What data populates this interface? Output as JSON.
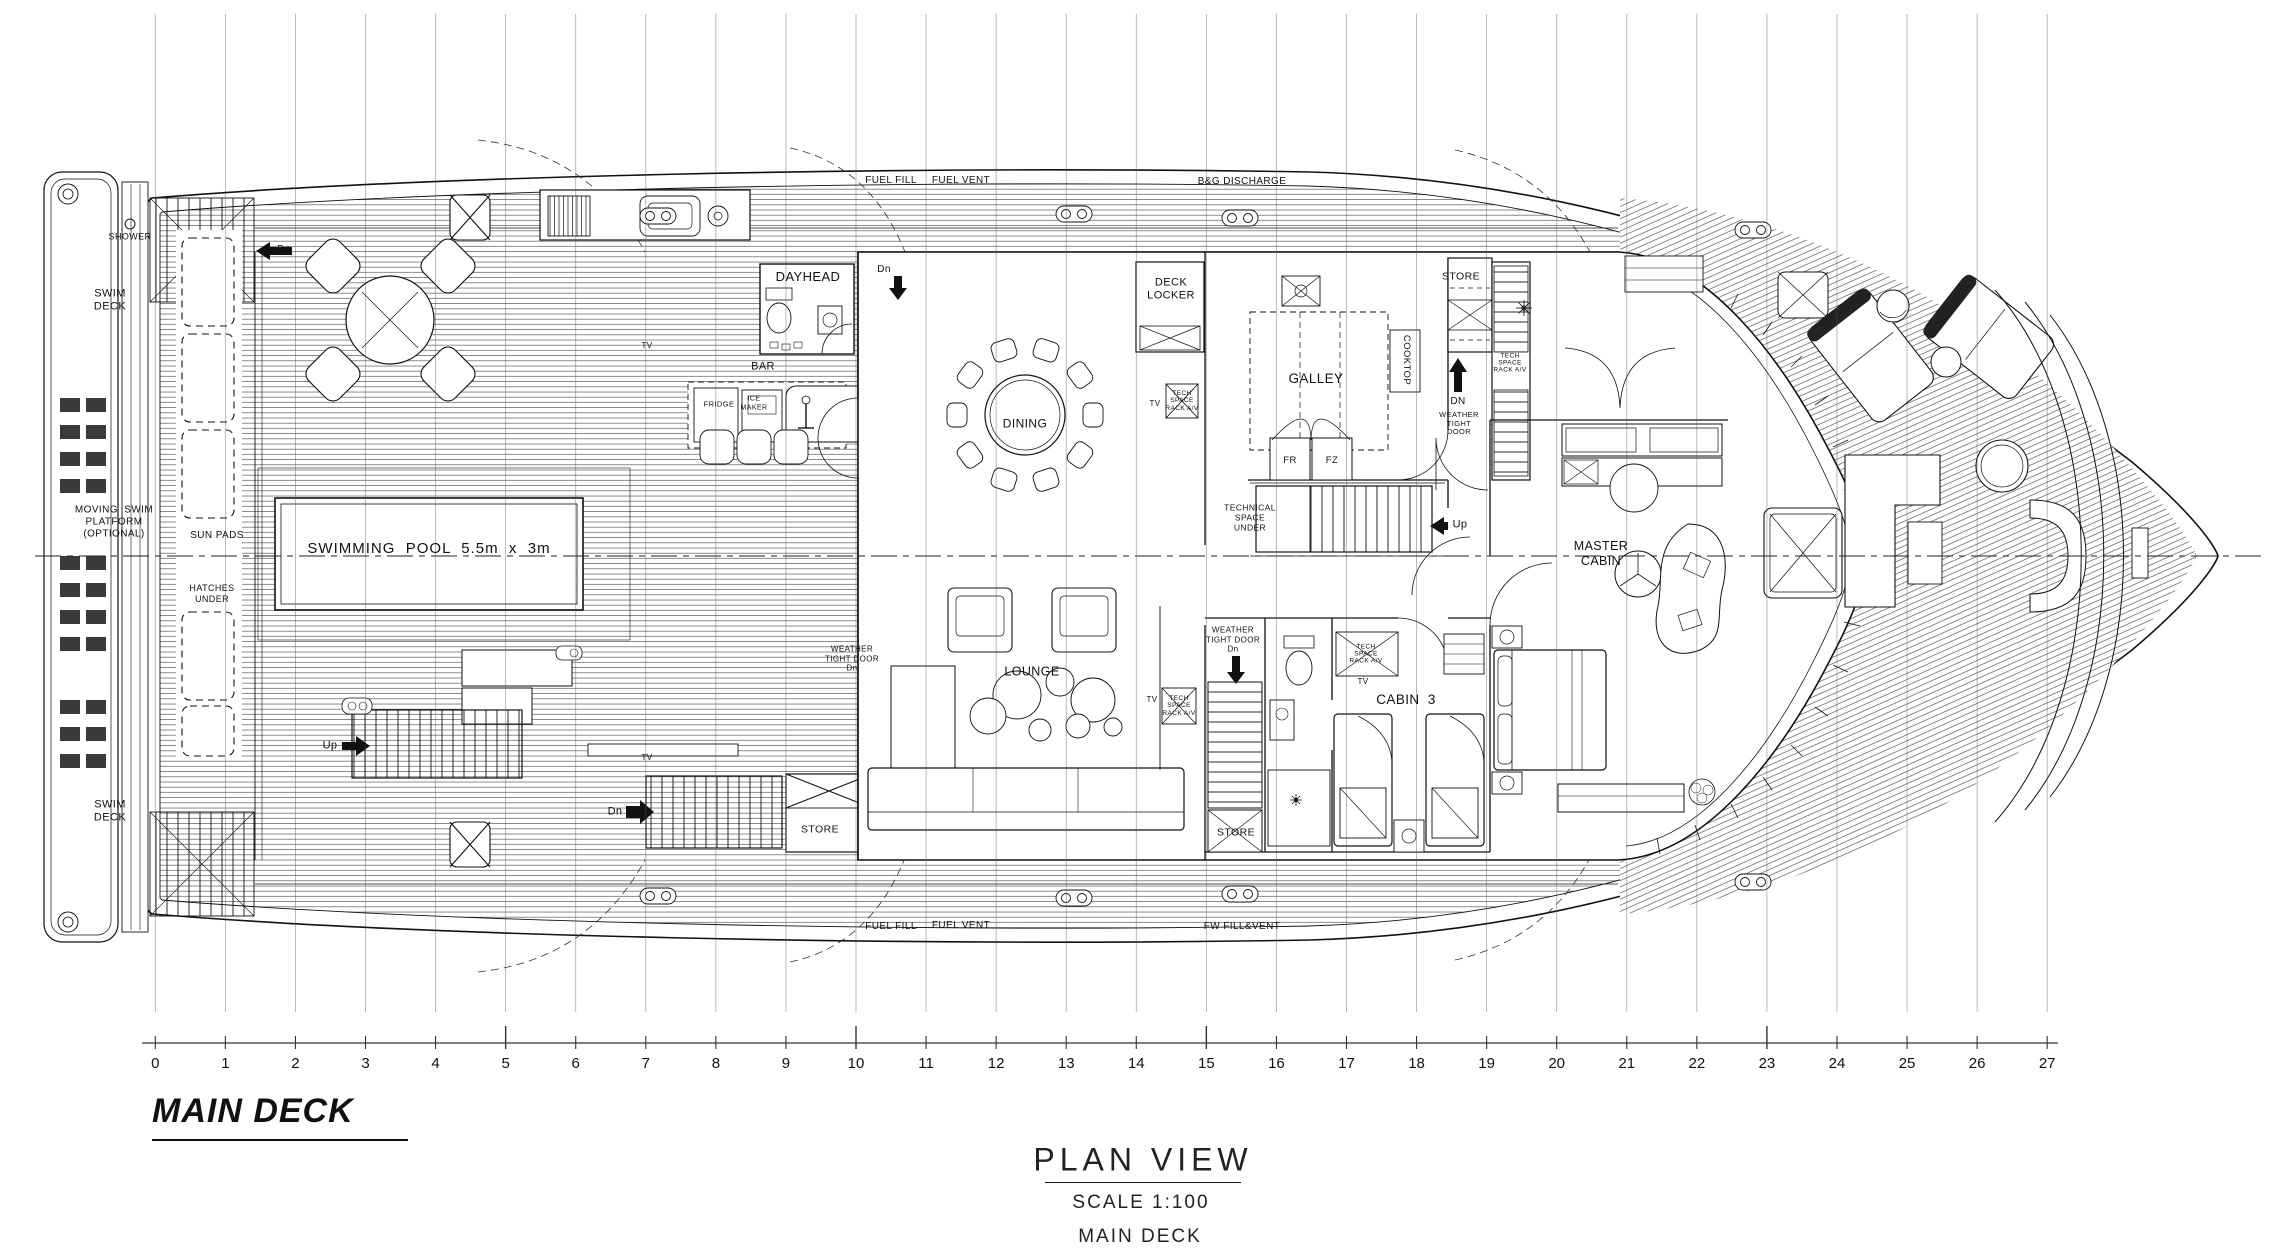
{
  "title_block": {
    "deck_title": "MAIN DECK",
    "view_title": "PLAN VIEW",
    "scale": "SCALE 1:100",
    "view_subtitle": "MAIN DECK"
  },
  "annotations": {
    "top": [
      "FUEL FILL",
      "FUEL VENT",
      "B&G DISCHARGE"
    ],
    "bottom": [
      "FUEL FILL",
      "FUEL VENT",
      "FW FILL&VENT"
    ]
  },
  "labels": {
    "shower": "SHOWER",
    "swim_deck": "SWIM\nDECK",
    "moving_platform": "MOVING  SWIM\nPLATFORM\n(OPTIONAL)",
    "sun_pads": "SUN PADS",
    "hatches_under": "HATCHES\nUNDER",
    "swimming_pool": "SWIMMING  POOL  5.5m  x  3m",
    "up": "Up",
    "dn": "Dn",
    "dn_caps": "DN",
    "dayhead": "DAYHEAD",
    "bar": "BAR",
    "fridge": "FRIDGE",
    "ice_maker": "ICE\nMAKER",
    "tv": "TV",
    "dining": "DINING",
    "lounge": "LOUNGE",
    "deck_locker": "DECK\nLOCKER",
    "galley": "GALLEY",
    "fr": "FR",
    "fz": "FZ",
    "cooktop": "COOKTOP",
    "store": "STORE",
    "technical_space": "TECHNICAL\nSPACE\nUNDER",
    "tech_rack": "TECH\nSPACE\nRACK A/V",
    "weather_tight_door": "WEATHER\nTIGHT\nDOOR",
    "weather_tight_door_dn": "WEATHER\nTIGHT DOOR\nDn",
    "cabin3": "CABIN  3",
    "master_cabin": "MASTER\nCABIN"
  },
  "ruler": {
    "start": 0,
    "end": 27,
    "major_ticks": [
      5,
      10,
      15,
      23
    ]
  },
  "style": {
    "line_color": "#111111",
    "background": "#ffffff"
  }
}
